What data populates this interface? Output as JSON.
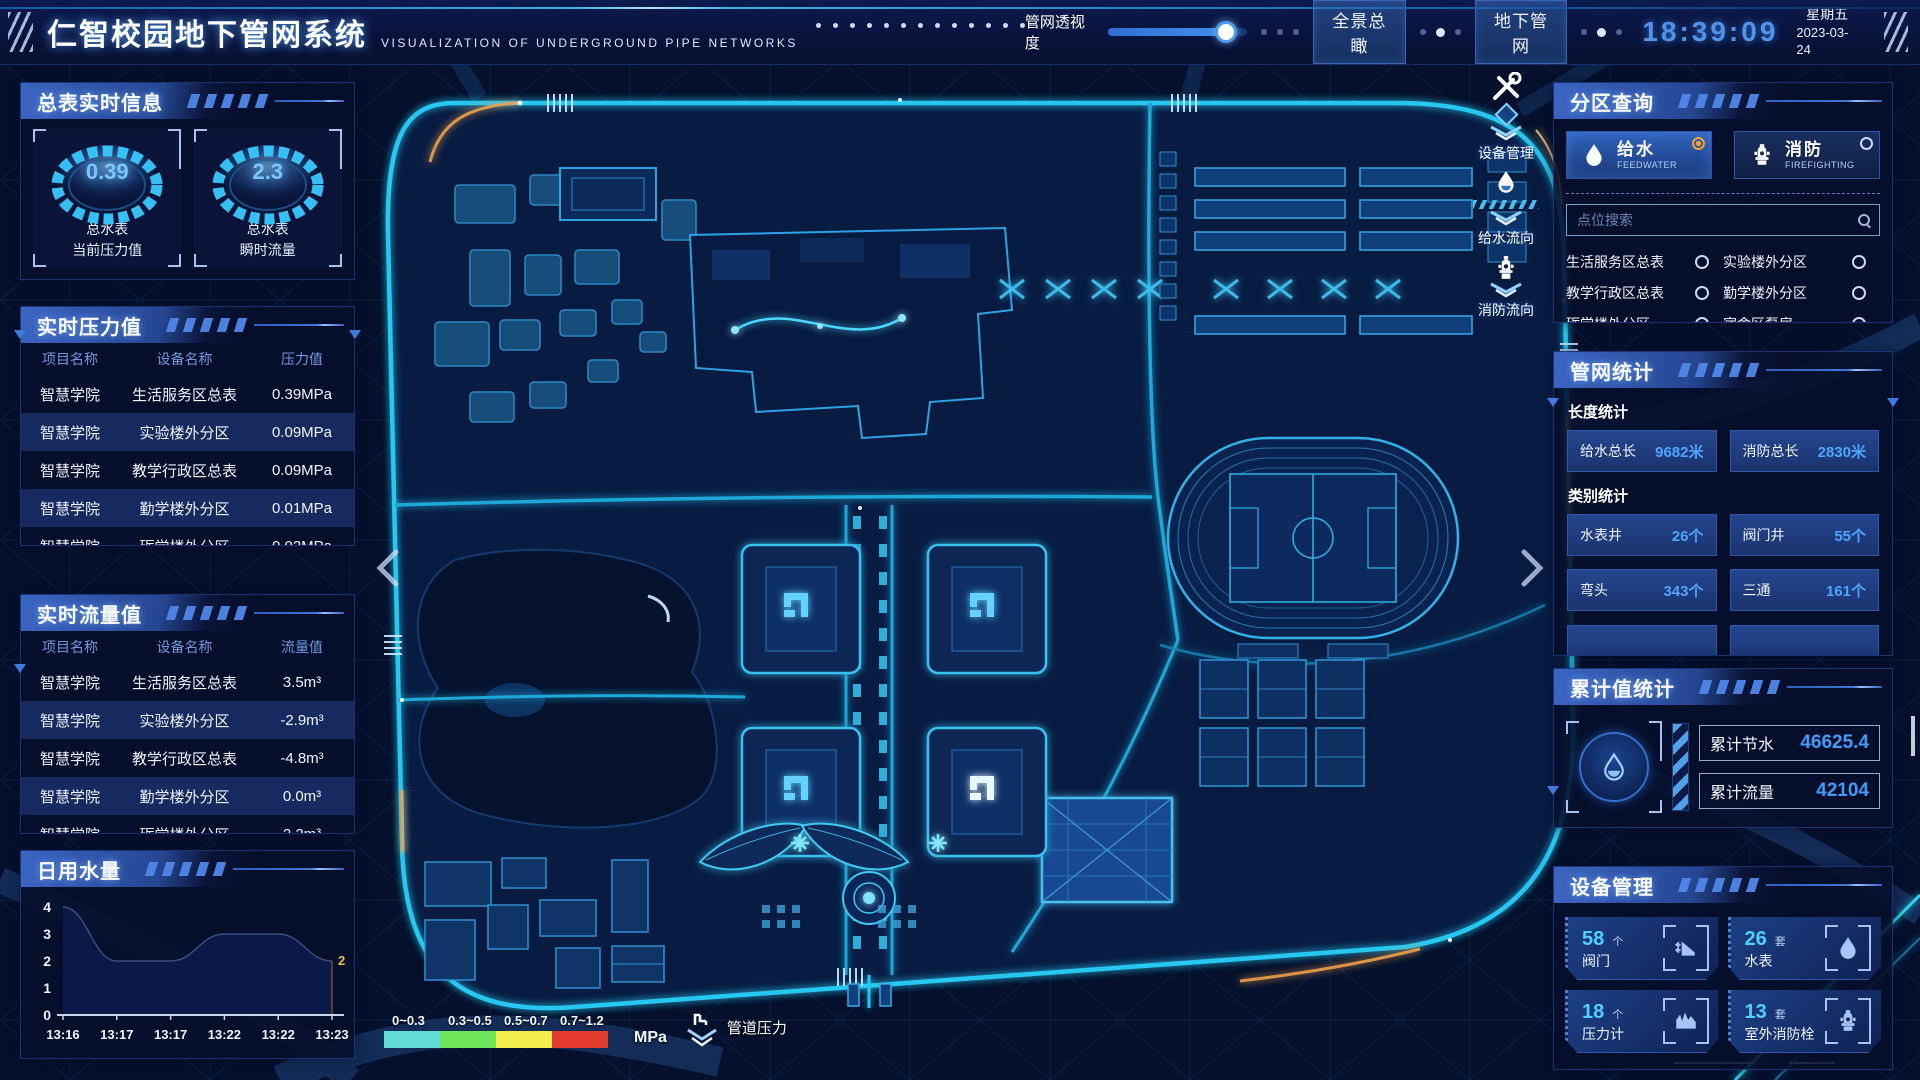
{
  "header": {
    "title": "仁智校园地下管网系统",
    "subtitle": "VISUALIZATION OF UNDERGROUND PIPE NETWORKS",
    "opacity_label": "管网透视度",
    "opacity_percent": 85,
    "buttons": {
      "overview": "全景总瞰",
      "underground": "地下管网"
    },
    "clock": {
      "time": "18:39:09",
      "weekday": "星期五",
      "date": "2023-03-24"
    }
  },
  "left_panel": {
    "meter_section": {
      "title": "总表实时信息",
      "gauges": [
        {
          "value": "0.39",
          "label": "总水表",
          "sublabel": "当前压力值"
        },
        {
          "value": "2.3",
          "label": "总水表",
          "sublabel": "瞬时流量"
        }
      ]
    },
    "pressure_section": {
      "title": "实时压力值",
      "columns": [
        "项目名称",
        "设备名称",
        "压力值"
      ],
      "rows": [
        [
          "智慧学院",
          "生活服务区总表",
          "0.39MPa"
        ],
        [
          "智慧学院",
          "实验楼外分区",
          "0.09MPa"
        ],
        [
          "智慧学院",
          "教学行政区总表",
          "0.09MPa"
        ],
        [
          "智慧学院",
          "勤学楼外分区",
          "0.01MPa"
        ],
        [
          "智慧学院",
          "砺学楼外分区",
          "0.02MPa"
        ]
      ]
    },
    "flow_section": {
      "title": "实时流量值",
      "columns": [
        "项目名称",
        "设备名称",
        "流量值"
      ],
      "rows": [
        [
          "智慧学院",
          "生活服务区总表",
          "3.5m³"
        ],
        [
          "智慧学院",
          "实验楼外分区",
          "-2.9m³"
        ],
        [
          "智慧学院",
          "教学行政区总表",
          "-4.8m³"
        ],
        [
          "智慧学院",
          "勤学楼外分区",
          "0.0m³"
        ],
        [
          "智慧学院",
          "砺学楼外分区",
          "2.2m³"
        ]
      ]
    },
    "daily_section": {
      "title": "日用水量"
    }
  },
  "chart_data": {
    "type": "area",
    "title": "日用水量",
    "x": [
      "13:16",
      "13:17",
      "13:17",
      "13:22",
      "13:22",
      "13:23"
    ],
    "values": [
      4,
      2,
      2,
      3,
      3,
      2
    ],
    "ylim": [
      0,
      4
    ],
    "yticks": [
      0,
      1,
      2,
      3,
      4
    ],
    "end_label": "2",
    "fill": "#0a1a4a",
    "grid": false,
    "legend_position": "none"
  },
  "right_panel": {
    "zone_section": {
      "title": "分区查询",
      "toggles": [
        {
          "label": "给水",
          "sublabel": "FEEDWATER",
          "selected": true
        },
        {
          "label": "消防",
          "sublabel": "FIREFIGHTING",
          "selected": false
        }
      ],
      "search_placeholder": "点位搜索",
      "points": [
        "生活服务区总表",
        "实验楼外分区",
        "教学行政区总表",
        "勤学楼外分区",
        "砺学楼外分区",
        "宿舍区泵房"
      ]
    },
    "stats_section": {
      "title": "管网统计",
      "length_title": "长度统计",
      "length_stats": [
        {
          "label": "给水总长",
          "value": "9682米"
        },
        {
          "label": "消防总长",
          "value": "2830米"
        }
      ],
      "category_title": "类别统计",
      "category_stats": [
        {
          "label": "水表井",
          "value": "26个"
        },
        {
          "label": "阀门井",
          "value": "55个"
        },
        {
          "label": "弯头",
          "value": "343个"
        },
        {
          "label": "三通",
          "value": "161个"
        }
      ]
    },
    "total_section": {
      "title": "累计值统计",
      "stats": [
        {
          "label": "累计节水",
          "value": "46625.4"
        },
        {
          "label": "累计流量",
          "value": "42104"
        }
      ]
    },
    "device_section": {
      "title": "设备管理",
      "devices": [
        {
          "count": "58",
          "unit": "个",
          "name": "阀门"
        },
        {
          "count": "26",
          "unit": "套",
          "name": "水表"
        },
        {
          "count": "18",
          "unit": "个",
          "name": "压力计"
        },
        {
          "count": "13",
          "unit": "套",
          "name": "室外消防栓"
        }
      ]
    }
  },
  "map_overlay": {
    "tools": [
      {
        "label": "设备管理"
      },
      {
        "label": "给水流向"
      },
      {
        "label": "消防流向"
      }
    ]
  },
  "legend": {
    "segments": [
      {
        "label": "0~0.3",
        "color": "#62dcd8"
      },
      {
        "label": "0.3~0.5",
        "color": "#6ee55a"
      },
      {
        "label": "0.5~0.7",
        "color": "#f2ee4e"
      },
      {
        "label": "0.7~1.2",
        "color": "#e23b2e"
      }
    ],
    "unit": "MPa",
    "label": "管道压力"
  },
  "colors": {
    "accent": "#2fc6f2",
    "selected_radio": "#f0a22c",
    "road_glow": "#27c7f0"
  }
}
